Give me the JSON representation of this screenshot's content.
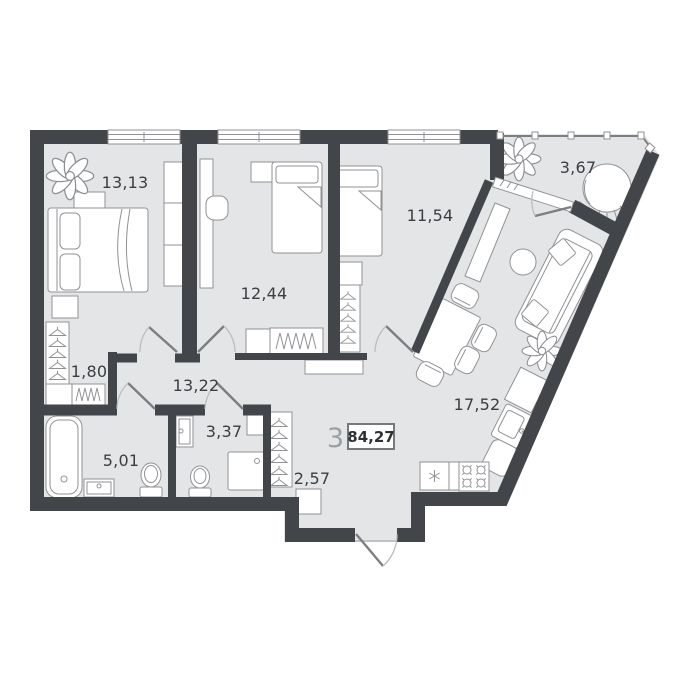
{
  "plan": {
    "areas": {
      "bedroom_1": "13,13",
      "bedroom_2": "12,44",
      "bedroom_3": "11,54",
      "balcony": "3,67",
      "closet": "1,80",
      "hallway": "13,22",
      "bathroom": "5,01",
      "wc": "3,37",
      "entry": "2,57",
      "kitchen_living": "17,52"
    },
    "summary": {
      "rooms_count": "3",
      "total_area": "84,27"
    },
    "colors": {
      "wall": "#42464b",
      "floor": "#e4e5e7",
      "furniture_stroke": "#909296",
      "label_text": "#3a3d41",
      "muted_text": "#9b9ea2",
      "background": "#ffffff"
    }
  }
}
